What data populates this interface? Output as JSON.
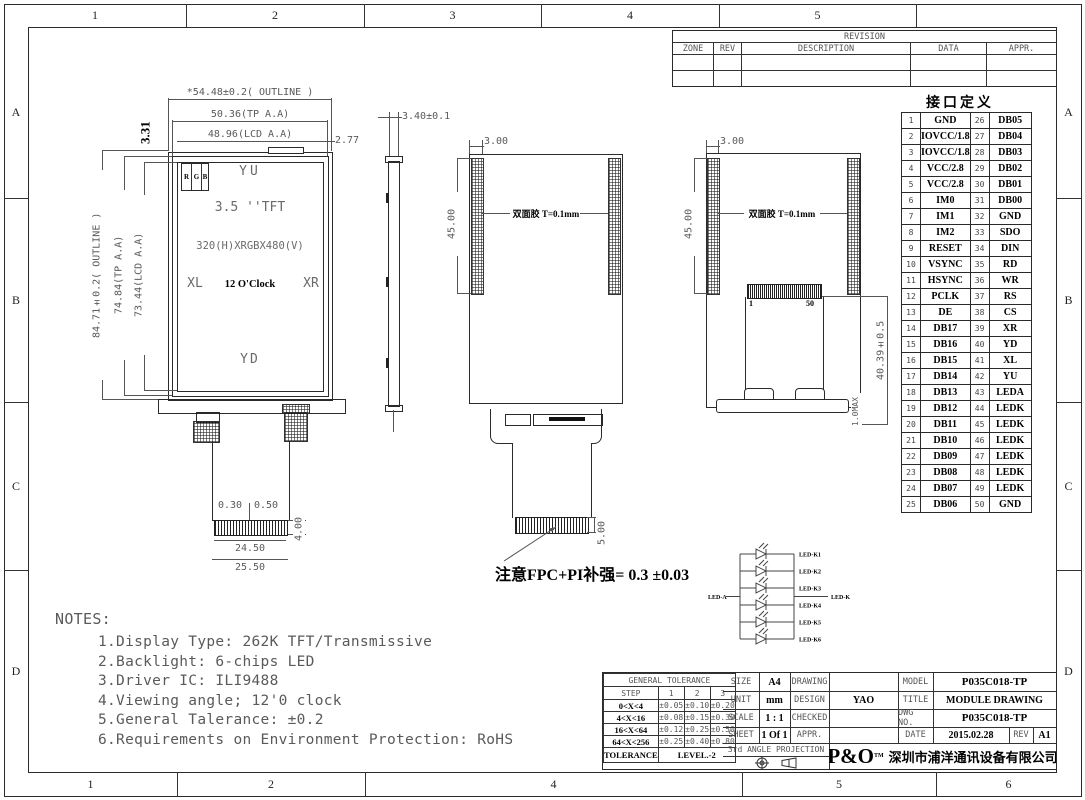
{
  "frame": {
    "top_zones": [
      "1",
      "2",
      "3",
      "4",
      "5",
      ""
    ],
    "bottom_zones": [
      "1",
      "2",
      "4",
      "5",
      "6"
    ],
    "side_rows": [
      "A",
      "B",
      "C",
      "D"
    ]
  },
  "revision_table": {
    "title": "REVISION",
    "cols": [
      "ZONE",
      "REV",
      "DESCRIPTION",
      "DATA",
      "APPR."
    ]
  },
  "pin_table": {
    "title": "接口定义",
    "rows": [
      [
        "1",
        "GND",
        "26",
        "DB05"
      ],
      [
        "2",
        "IOVCC/1.8",
        "27",
        "DB04"
      ],
      [
        "3",
        "IOVCC/1.8",
        "28",
        "DB03"
      ],
      [
        "4",
        "VCC/2.8",
        "29",
        "DB02"
      ],
      [
        "5",
        "VCC/2.8",
        "30",
        "DB01"
      ],
      [
        "6",
        "IM0",
        "31",
        "DB00"
      ],
      [
        "7",
        "IM1",
        "32",
        "GND"
      ],
      [
        "8",
        "IM2",
        "33",
        "SDO"
      ],
      [
        "9",
        "RESET",
        "34",
        "DIN"
      ],
      [
        "10",
        "VSYNC",
        "35",
        "RD"
      ],
      [
        "11",
        "HSYNC",
        "36",
        "WR"
      ],
      [
        "12",
        "PCLK",
        "37",
        "RS"
      ],
      [
        "13",
        "DE",
        "38",
        "CS"
      ],
      [
        "14",
        "DB17",
        "39",
        "XR"
      ],
      [
        "15",
        "DB16",
        "40",
        "YD"
      ],
      [
        "16",
        "DB15",
        "41",
        "XL"
      ],
      [
        "17",
        "DB14",
        "42",
        "YU"
      ],
      [
        "18",
        "DB13",
        "43",
        "LEDA"
      ],
      [
        "19",
        "DB12",
        "44",
        "LEDK"
      ],
      [
        "20",
        "DB11",
        "45",
        "LEDK"
      ],
      [
        "21",
        "DB10",
        "46",
        "LEDK"
      ],
      [
        "22",
        "DB09",
        "47",
        "LEDK"
      ],
      [
        "23",
        "DB08",
        "48",
        "LEDK"
      ],
      [
        "24",
        "DB07",
        "49",
        "LEDK"
      ],
      [
        "25",
        "DB06",
        "50",
        "GND"
      ]
    ]
  },
  "front_view": {
    "dim_outline_w": "*54.48±0.2( OUTLINE )",
    "dim_tp_w": "50.36(TP A.A)",
    "dim_lcd_w": "48.96(LCD A.A)",
    "dim_right": "2.77",
    "dim_331": "3.31",
    "dim_outline_h": "84.71±0.2( OUTLINE )",
    "dim_tp_h": "74.84(TP A.A)",
    "dim_lcd_h": "73.44(LCD A.A)",
    "rgb": [
      "R",
      "G",
      "B"
    ],
    "label_yu": "YU",
    "label_type": "3.5  ''TFT",
    "label_res": "320(H)XRGBX480(V)",
    "label_xl": "XL",
    "label_clock": "12 O'Clock",
    "label_xr": "XR",
    "label_yd": "YD",
    "dim_030": "0.30",
    "dim_050": "0.50",
    "dim_2450": "24.50",
    "dim_2550": "25.50",
    "dim_400": "4.00"
  },
  "side_view": {
    "dim_thickness": "3.40±0.1"
  },
  "back_view_a": {
    "dim_top": "3.00",
    "dim_left": "45.00",
    "label_tape": "双面胶 T=0.1mm",
    "dim_gold": "5.00"
  },
  "back_view_b": {
    "dim_top": "3.00",
    "dim_left": "45.00",
    "label_tape": "双面胶 T=0.1mm",
    "pin_first": "1",
    "pin_last": "50",
    "dim_height": "40.39±0.5",
    "dim_max": "1.0MAX"
  },
  "fpc_note": "注意FPC+PI补强= 0.3 ±0.03",
  "led_circuit": {
    "anode": "LED-A",
    "cathode": "LED-K",
    "cathodes": [
      "LED-K1",
      "LED-K2",
      "LED-K3",
      "LED-K4",
      "LED-K5",
      "LED-K6"
    ]
  },
  "notes": {
    "title": "NOTES:",
    "items": [
      "1.Display Type: 262K TFT/Transmissive",
      "2.Backlight: 6-chips LED",
      "3.Driver IC: ILI9488",
      "4.Viewing angle; 12'0 clock",
      "5.General Talerance: ±0.2",
      "6.Requirements on Environment Protection: RoHS"
    ]
  },
  "title_block": {
    "general_tolerance": {
      "title": "GENERAL TOLERANCE",
      "header": [
        "STEP",
        "1",
        "2",
        "3"
      ],
      "rows": [
        [
          "0<X<4",
          "±0.05",
          "±0.10",
          "±0.20"
        ],
        [
          "4<X<16",
          "±0.08",
          "±0.15",
          "±0.30"
        ],
        [
          "16<X<64",
          "±0.12",
          "±0.25",
          "±0.50"
        ],
        [
          "64<X<256",
          "±0.25",
          "±0.40",
          "±0.80"
        ]
      ],
      "footer_label": "TOLERANCE",
      "footer_value": "LEVEL.-2"
    },
    "info": {
      "size_label": "SIZE",
      "size": "A4",
      "unit_label": "UNIT",
      "unit": "mm",
      "scale_label": "SCALE",
      "scale": "1 : 1",
      "sheet_label": "SHEET",
      "sheet": "1 Of 1",
      "drawing_label": "DRAWING",
      "design_label": "DESIGN",
      "design": "YAO",
      "checked_label": "CHECKED",
      "appr_label": "APPR.",
      "projection": "3rd ANGLE PROJECTION"
    },
    "right": {
      "model_label": "MODEL",
      "model": "P035C018-TP",
      "title_label": "TITLE",
      "title": "MODULE DRAWING",
      "dwg_label": "DWG NO.",
      "dwg": "P035C018-TP",
      "date_label": "DATE",
      "date": "2015.02.28",
      "rev_label": "REV",
      "rev": "A1"
    },
    "company": {
      "logo": "P&O",
      "tm": "TM",
      "name": "深圳市浦洋通讯设备有限公司"
    }
  }
}
